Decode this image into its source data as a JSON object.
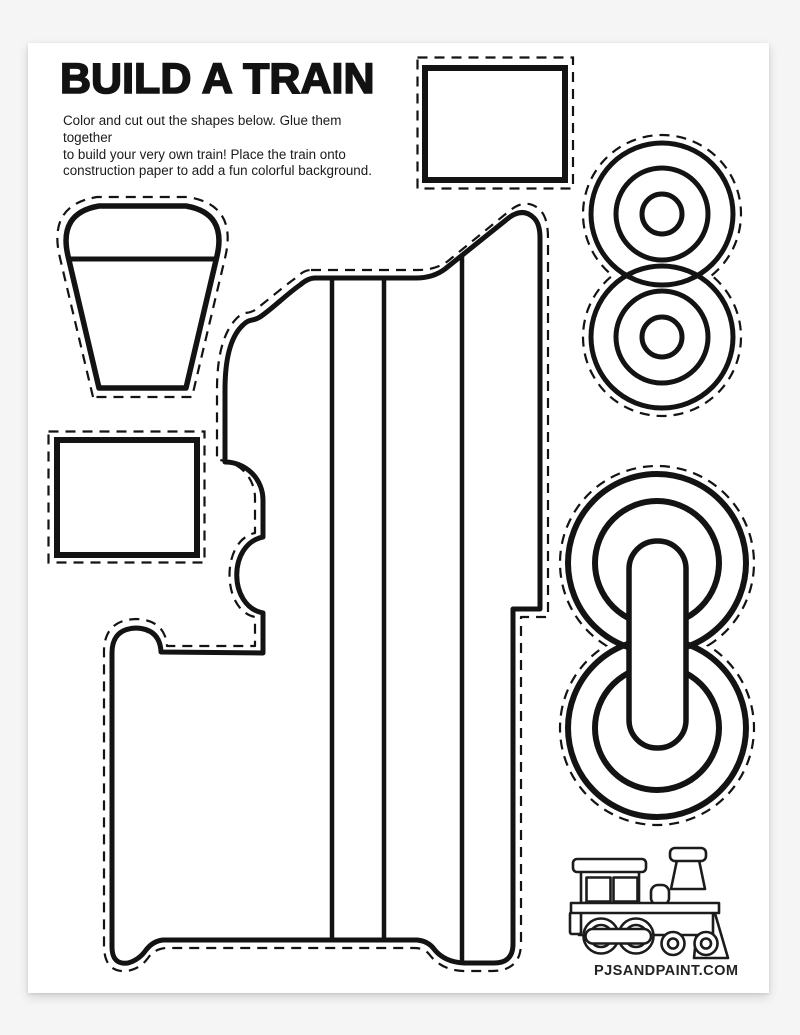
{
  "page": {
    "title": "BUILD A TRAIN",
    "instructions": [
      "Color and cut out the shapes below. Glue them together",
      "to build your very own train! Place the train onto",
      "construction paper to add a fun colorful background."
    ],
    "footer_site": "PJSANDPAINT.COM"
  },
  "pieces": [
    "smokestack",
    "rectangle-large",
    "rectangle-small",
    "train-engine-body",
    "small-wheel-pair",
    "large-wheel-pair-with-coupling-rod",
    "train-logo"
  ],
  "colors": {
    "ink": "#131313",
    "paper": "#ffffff",
    "background": "#f5f5f6"
  }
}
